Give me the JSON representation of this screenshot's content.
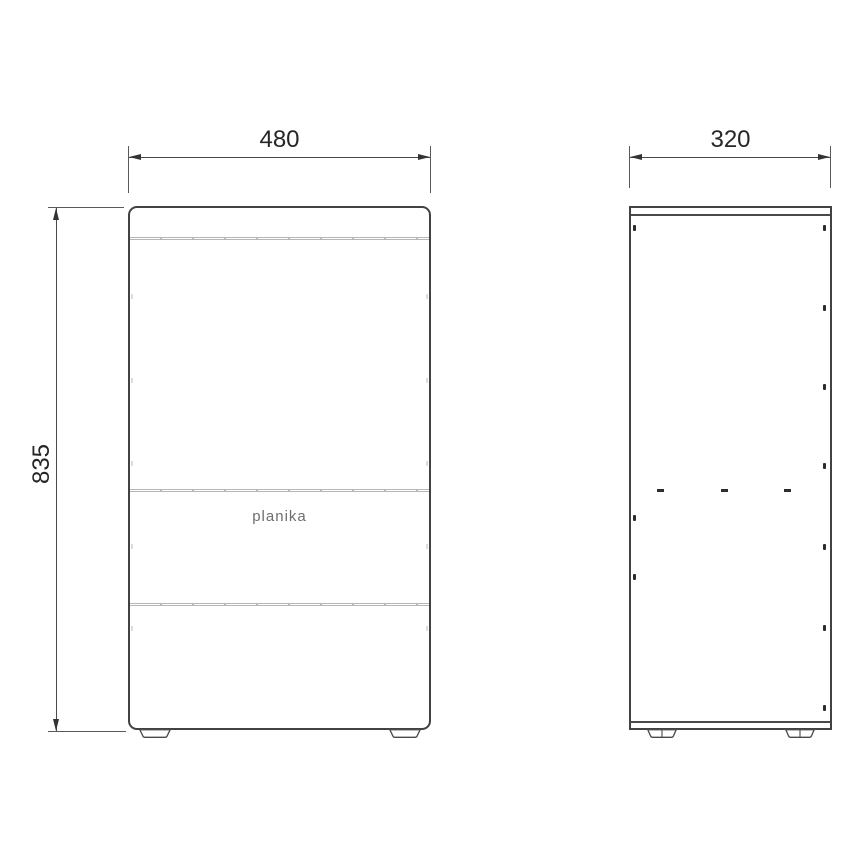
{
  "drawing": {
    "dimensions": {
      "front_width": "480",
      "front_height": "835",
      "side_depth": "320"
    },
    "brand": {
      "logo_text": "planika"
    },
    "colors": {
      "outline": "#424242",
      "dimension_line": "#4a4a4a",
      "arrow": "#333333",
      "seam": "#b6b6b6",
      "logo_text": "#6e6e6e",
      "background": "#ffffff"
    }
  }
}
